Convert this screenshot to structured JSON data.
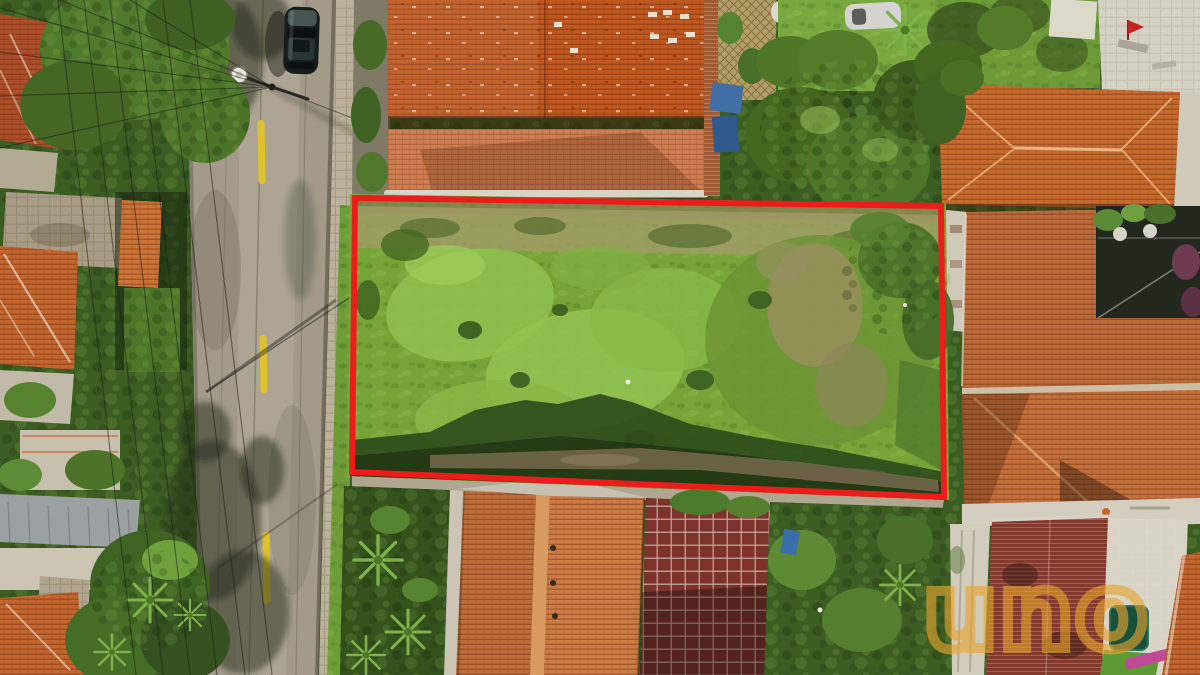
{
  "watermark": {
    "text": "uno",
    "color": "#E8A42C",
    "opacity": 0.62
  },
  "lot_outline": {
    "color": "#EE1B1B",
    "stroke_px": 6,
    "points": "355,198 941,206 944,497 352,472"
  },
  "road": {
    "asphalt_color": "#A39A89",
    "marking_color": "#DFC22E",
    "marking_style": "dashed-center-line"
  },
  "palette": {
    "grass_bright": "#93C351",
    "grass_mid": "#76A437",
    "grass_shadow": "#2C4A1B",
    "dry_grass": "#A39B66",
    "dirt": "#7B6C4F",
    "roof_terracotta": "#C1581F",
    "roof_light": "#CD7E52",
    "roof_dark_red": "#7D332B",
    "foliage_dark": "#3C5D22",
    "foliage_light": "#6E9440",
    "sidewalk": "#BCB29C",
    "wall_white": "#D5D1C3"
  },
  "scene": {
    "type": "aerial-drone-photo",
    "subject": "vacant residential grass lot outlined in red between terracotta-roofed houses",
    "objects": [
      "street-with-yellow-dashes",
      "parked-dark-car",
      "street-lamp",
      "power-lines",
      "terracotta-roofs",
      "vacant-grass-lot",
      "red-boundary-outline",
      "watermark-logo"
    ]
  }
}
